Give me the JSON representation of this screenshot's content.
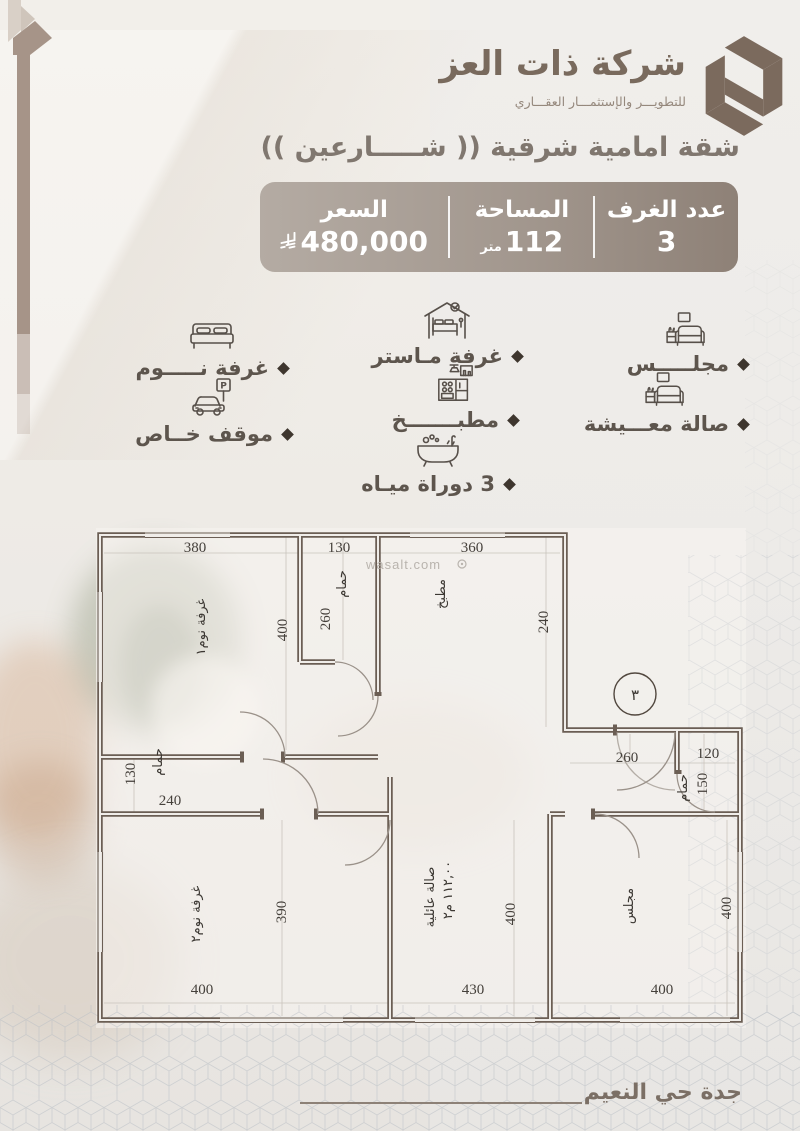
{
  "brand": {
    "name": "شركة ذات العز",
    "tagline": "للتطويـــر والإستثمـــار العقـــاري"
  },
  "title": "شقة امامية شرقية (( شـــــارعين ))",
  "info_bar": {
    "rooms": {
      "label": "عدد الغرف",
      "value": "3"
    },
    "area": {
      "label": "المساحة",
      "value": "112",
      "unit": "متر"
    },
    "price": {
      "label": "السعر",
      "value": "480,000",
      "currency_icon": "saudi-riyal-icon"
    }
  },
  "features": [
    {
      "icon": "sofa-icon",
      "label": "مجلـــــس"
    },
    {
      "icon": "sofa-icon",
      "label": "صالة معـــيشة"
    },
    {
      "icon": "master-bedroom-icon",
      "label": "غرفة مـاستر"
    },
    {
      "icon": "kitchen-icon",
      "label": "مطبـــــــخ"
    },
    {
      "icon": "bathtub-icon",
      "label": "3 دوراة ميـاه"
    },
    {
      "icon": "bed-icon",
      "label": "غرفة نـــــوم"
    },
    {
      "icon": "car-parking-icon",
      "label": "موقف خــاص"
    }
  ],
  "floor_plan": {
    "watermark": "wasalt.com",
    "unit_number": "٣",
    "bedroom1": {
      "name": "غرفة نوم١",
      "width": "380",
      "height": "400"
    },
    "bath1": {
      "name": "حمام",
      "width": "130",
      "height": "260"
    },
    "kitchen": {
      "name": "مطبخ",
      "width": "360",
      "height": "240"
    },
    "bath2": {
      "name": "حمام",
      "width": "240",
      "height": "130"
    },
    "bedroom2": {
      "name": "غرفة نوم٢",
      "width": "400",
      "height": "390"
    },
    "family_hall": {
      "name": "صالة عائلية",
      "area": "١١٢,٠٠ م٢",
      "width": "430",
      "height": "400"
    },
    "majlis": {
      "name": "مجلس",
      "width": "400",
      "height": "400"
    },
    "bath3": {
      "name": "حمام",
      "width": "120",
      "height": "150"
    },
    "entry": {
      "width": "260"
    }
  },
  "footer": {
    "location": "جدة حي النعيم"
  },
  "colors": {
    "brand_brown": "#7b6a5d",
    "bar_dark": "#8e8177",
    "bar_light": "#b4aba3",
    "wall": "#6b5e54",
    "accent_text": "#5d554d"
  }
}
